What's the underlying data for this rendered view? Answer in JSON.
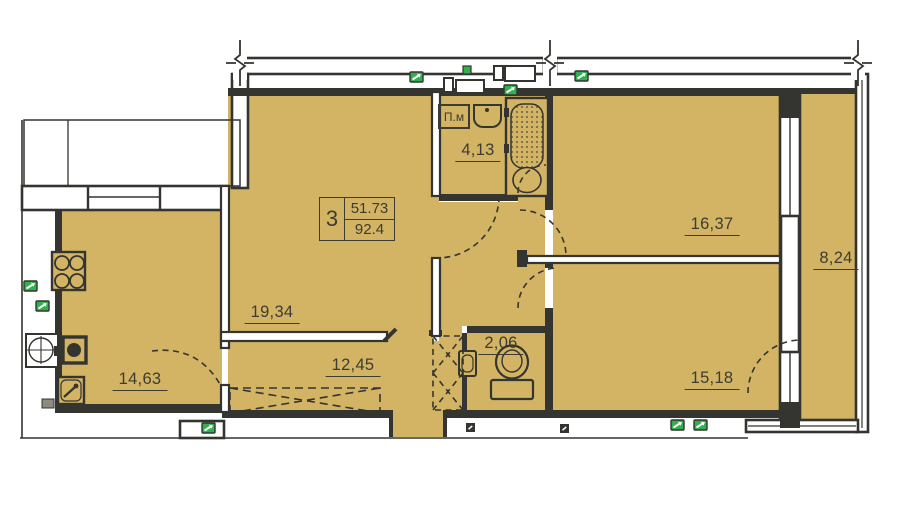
{
  "stamp": {
    "rooms_count": "3",
    "living_area": "51.73",
    "total_area": "92.4"
  },
  "rooms": {
    "living": {
      "area": "19,34"
    },
    "kitchen": {
      "area": "14,63"
    },
    "hall": {
      "area": "12,45"
    },
    "bathroom": {
      "area": "4,13"
    },
    "wc": {
      "area": "2,06"
    },
    "bedroom1": {
      "area": "16,37"
    },
    "bedroom2": {
      "area": "15,18"
    },
    "loggia": {
      "area": "8,24"
    }
  },
  "fixtures": {
    "washing_machine_label": "П.м"
  },
  "colors": {
    "room_fill": "#d3b464",
    "wall": "#343430",
    "vent_green": "#2fb14d",
    "label_text": "#3c3c33",
    "background": "#ffffff"
  }
}
